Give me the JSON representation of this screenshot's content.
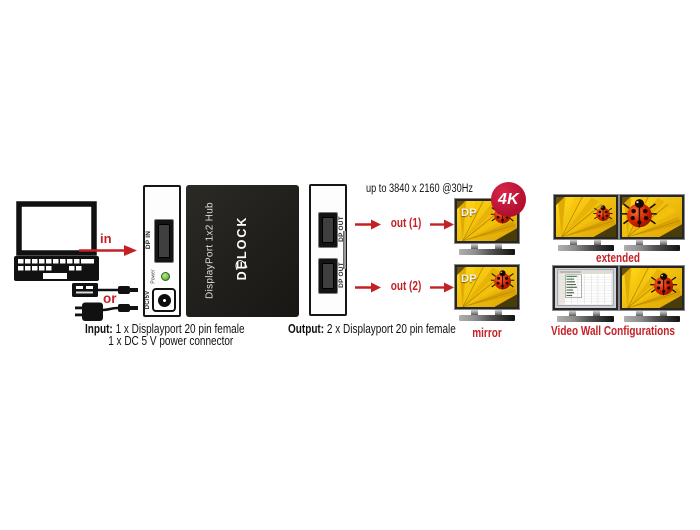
{
  "colors": {
    "accent_red": "#c42127",
    "badge_red": "#b30f2e",
    "led_green": "#7cc142",
    "hub_black": "#24221d"
  },
  "flow": {
    "in_label": "in",
    "or_label": "or",
    "out1_label": "out (1)",
    "out2_label": "out (2)"
  },
  "resolution_note": "up to 3840 x 2160 @30Hz",
  "badge_4k": "4K",
  "hub": {
    "model_text": "DisplayPort 1x2 Hub",
    "brand": "DELOCK",
    "input_panel": {
      "dp_in": "DP IN",
      "power": "Power",
      "dc": "DC/5V"
    },
    "output_panel": {
      "dp_out_1": "DP OUT",
      "dp_out_2": "DP OUT"
    }
  },
  "specs": {
    "input_label": "Input:",
    "input_items": [
      "1 x Displayport 20 pin female",
      "1 x DC 5 V power connector"
    ],
    "output_label": "Output:",
    "output_items": [
      "2 x Displayport 20 pin female"
    ]
  },
  "monitors": {
    "dp_overlay": "DP",
    "mirror_label": "mirror",
    "extended_label": "extended",
    "video_wall_label": "Video Wall Configurations"
  }
}
